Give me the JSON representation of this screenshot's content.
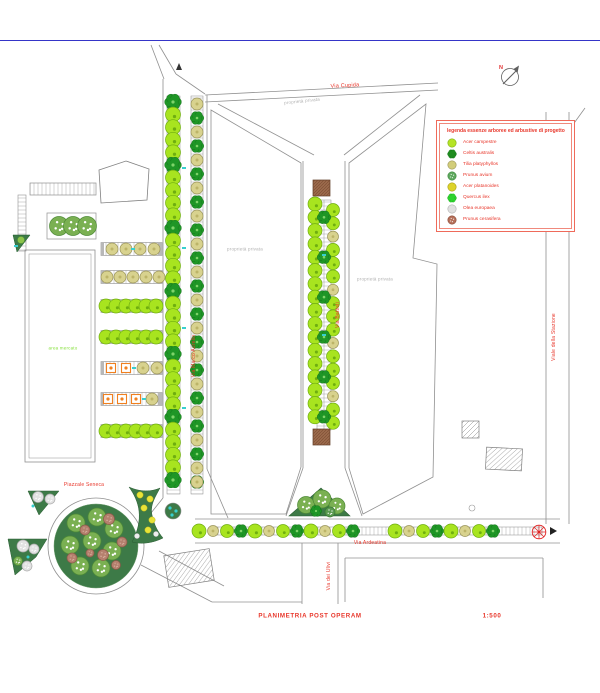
{
  "page": {
    "footer_title": "PLANIMETRIA POST OPERAM",
    "footer_scale": "1:500"
  },
  "streets": {
    "via_cupida": "Via Cupida",
    "via_battisti": "Via Battisti",
    "via_marco_aurelio": "Via Marco Aurelio",
    "viale_stazione": "Viale della Stazione",
    "via_ardeatina": "Via Ardeatina",
    "via_ulivi": "Via dei Ulivi",
    "piazzale": "Piazzale Seneca"
  },
  "areas": {
    "private_property": "proprietà privata",
    "market": "area mercato"
  },
  "compass": {
    "north_label": "N"
  },
  "legend": {
    "title": "legenda essenze arboree ed arbustive di progetto",
    "items": [
      {
        "label": "Acer campestre",
        "shape": "circle",
        "fill": "#b5e426",
        "edge": "#7fae12"
      },
      {
        "label": "Celtis australis",
        "shape": "clover",
        "fill": "#1f8c1f",
        "edge": "#0f6b16"
      },
      {
        "label": "Tilia platyphyllos",
        "shape": "circle",
        "fill": "#d2cd7a",
        "edge": "#9a945a"
      },
      {
        "label": "Prunus avium",
        "shape": "stipple",
        "fill": "#5fa85f",
        "edge": "#3d8a3d"
      },
      {
        "label": "Acer platanoides",
        "shape": "circle",
        "fill": "#ddd32a",
        "edge": "#a89e18"
      },
      {
        "label": "Quercus ilex",
        "shape": "clover",
        "fill": "#2ed32e",
        "edge": "#13a013"
      },
      {
        "label": "Olea europaea",
        "shape": "circle",
        "fill": "#e0e0e0",
        "edge": "#b0b0b0"
      },
      {
        "label": "Prunus cerasifera",
        "shape": "stipple",
        "fill": "#b5705a",
        "edge": "#8a4a38"
      }
    ]
  },
  "colors": {
    "accent_red": "#e8362a",
    "label_gray": "#b0b0b0",
    "label_green": "#86e03c",
    "tree_bright": "#a8e41f",
    "tree_bright_edge": "#6fae10",
    "tree_khaki": "#d8d28e",
    "tree_khaki_edge": "#9a945a",
    "tree_dark": "#1f9626",
    "tree_dark_edge": "#0f6b16",
    "tree_soft": "#7ab052",
    "tree_soft_edge": "#4d8a36",
    "tree_brown": "#b5806e",
    "tree_brown_edge": "#8a5a48",
    "area_green": "#3d7a47",
    "orange": "#f08020",
    "cyan": "#38cfcf",
    "road": "#909090",
    "planter_brown": "#9b6a4c",
    "blue_rule": "#3535c8",
    "dot_yellow": "#e8e337",
    "north_red": "#e03030"
  }
}
